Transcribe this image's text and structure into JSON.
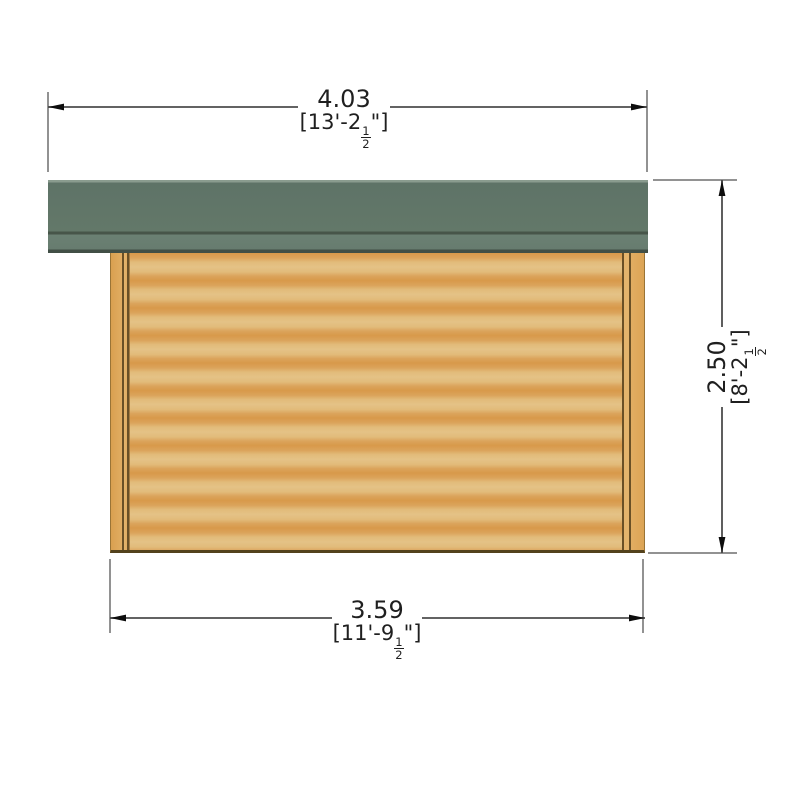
{
  "diagram": {
    "type": "side-elevation-dimension-drawing",
    "units_note": "metres over [feet-inches]"
  },
  "labels": {
    "top_width": {
      "metric": "4.03",
      "imperial_prefix": "[13'-2",
      "fraction_numerator": "1",
      "fraction_denominator": "2",
      "imperial_suffix": "\"]"
    },
    "bottom_width": {
      "metric": "3.59",
      "imperial_prefix": "[11'-9",
      "fraction_numerator": "1",
      "fraction_denominator": "2",
      "imperial_suffix": "\"]"
    },
    "right_height": {
      "metric": "2.50",
      "imperial_prefix": "[8'-2",
      "fraction_numerator": "1",
      "fraction_denominator": "2",
      "imperial_suffix": "\"]"
    }
  },
  "colors": {
    "background": "#ffffff",
    "roof_main": "#617669",
    "roof_fascia": "#677c6f",
    "roof_edge_line": "#414f46",
    "wood_dark_band": "#d8994a",
    "wood_light_band": "#e4c286",
    "post_line": "#6a5026",
    "wall_base_line": "#53421d",
    "dimension_line": "#4d4d4d",
    "extension_line": "#6e6e6e",
    "arrow": "#0d0d0d",
    "text": "#1f1f1f"
  }
}
